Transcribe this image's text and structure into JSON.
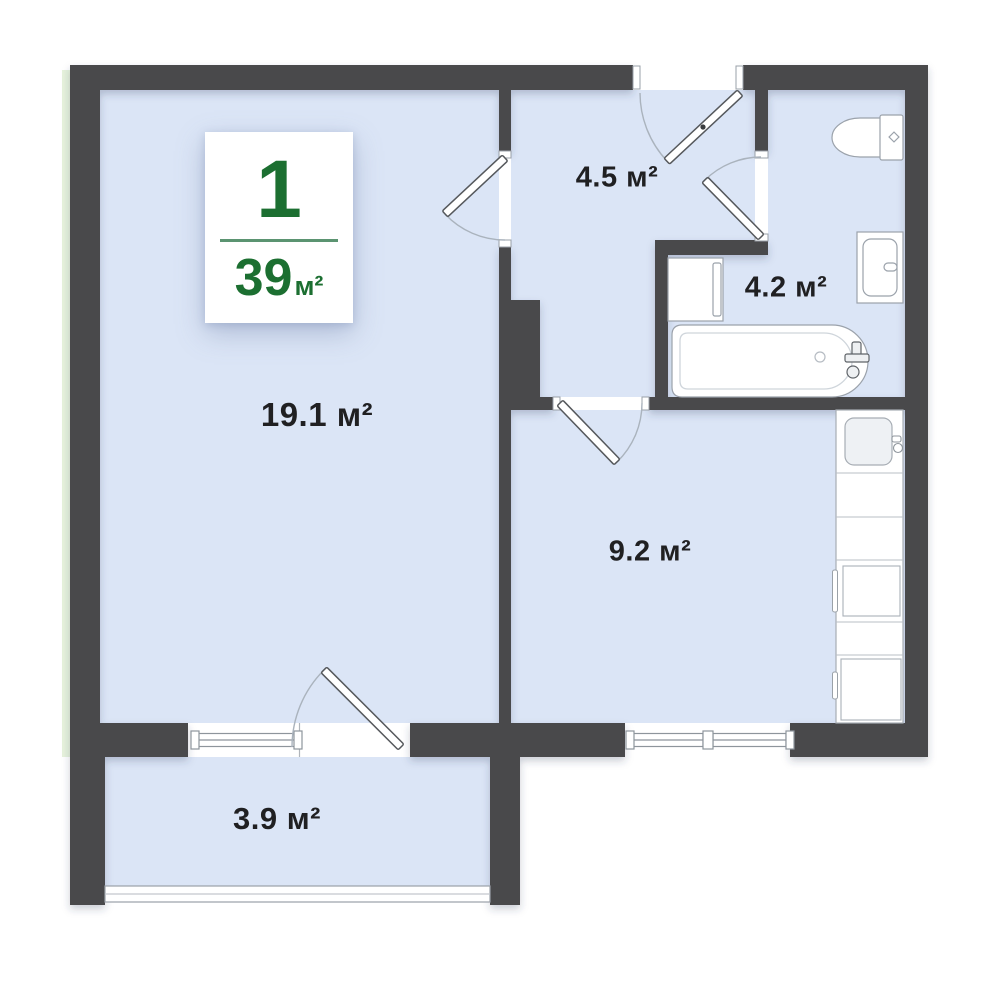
{
  "floor_plan": {
    "badge": {
      "room_count": "1",
      "total_area": "39",
      "unit": "м²"
    },
    "rooms": {
      "hallway": {
        "label": "4.5 м²"
      },
      "bathroom": {
        "label": "4.2 м²"
      },
      "living_room": {
        "label": "19.1 м²"
      },
      "kitchen": {
        "label": "9.2 м²"
      },
      "balcony": {
        "label": "3.9 м²"
      }
    },
    "fixtures": [
      "toilet",
      "bathroom-sink",
      "washing-machine",
      "bathtub",
      "kitchen-sink",
      "oven",
      "refrigerator"
    ],
    "colors": {
      "wall": "#494a4c",
      "floor": "#dbe5f6",
      "accent_green": "#1c6f31",
      "label_text": "#202022"
    }
  }
}
